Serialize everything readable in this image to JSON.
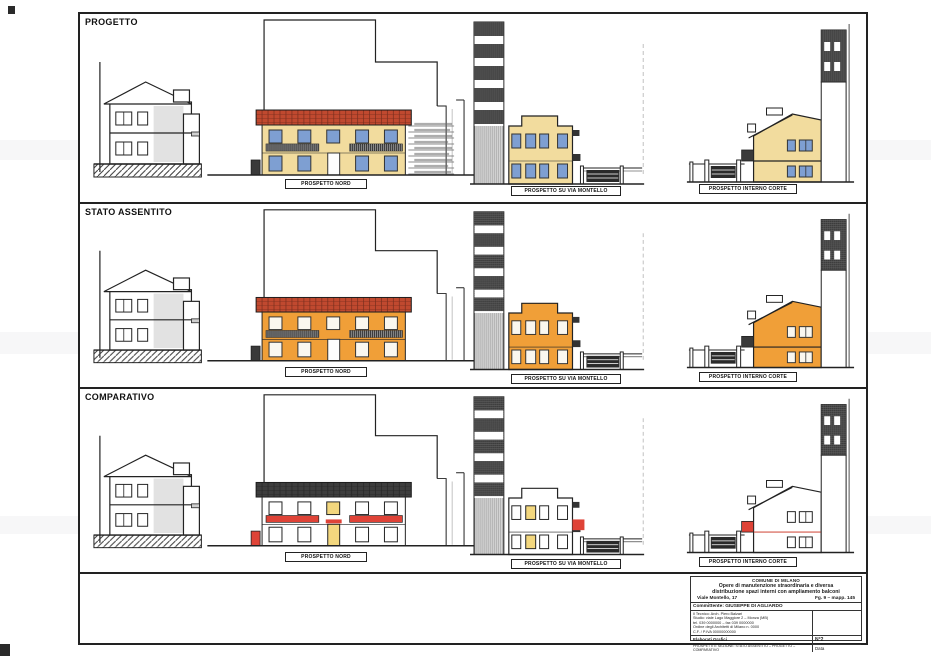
{
  "sheet": {
    "rows": [
      {
        "title": "PROGETTO",
        "labels": {
          "nord": "PROSPETTO NORD",
          "montello": "PROSPETTO SU VIA MONTELLO",
          "corte": "PROSPETTO INTERNO CORTE"
        }
      },
      {
        "title": "STATO ASSENTITO",
        "labels": {
          "nord": "PROSPETTO NORD",
          "montello": "PROSPETTO SU VIA MONTELLO",
          "corte": "PROSPETTO INTERNO CORTE"
        }
      },
      {
        "title": "COMPARATIVO",
        "labels": {
          "nord": "PROSPETTO NORD",
          "montello": "PROSPETTO SU VIA MONTELLO",
          "corte": "PROSPETTO INTERNO CORTE"
        }
      }
    ]
  },
  "title_block": {
    "municipality": "COMUNE DI MILANO",
    "work_line1": "Opere di manutenzione straordinaria e diversa",
    "work_line2": "distribuzione spazi interni con ampliamento balconi",
    "address": "Viale Montello, 17",
    "cadastre": "Fg. 9 – mapp. 145",
    "client": "Committente: GIUSEPPE DI AGLIARDO",
    "designer": {
      "line1": "Il Tecnico: Arch. Piero Balzari",
      "line2": "Studio: viale Lago Maggiore 2 – Monza (MB)",
      "line3": "tel. 039 0000000 – fax 039 0000000",
      "line4": "Ordine degli Architetti di Milano n. 0000",
      "line5": "C.F. / P.IVA 00000000000"
    },
    "drawing_title": "Elaborati Grafici",
    "drawing_desc": "PROSPETTI E SEZIONE: STATO ASSENTITO – PROGETTO – COMPARATIVO",
    "sheet_no": "N°2",
    "date_label": "Data"
  },
  "colors": {
    "progetto_facade": "#f2dc9e",
    "assentito_facade": "#f09f38",
    "comparativo_accent": "#df4337",
    "comparativo_yellow": "#f3d77e",
    "roof_red": "#c0492f",
    "roof_dark": "#3d3d3d",
    "window_blue": "#7e9fd2"
  }
}
